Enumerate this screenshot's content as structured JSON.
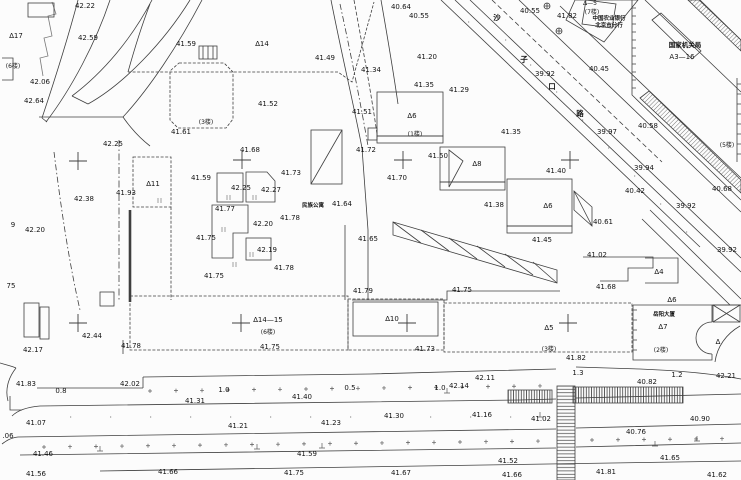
{
  "canvas": {
    "width": 741,
    "height": 480,
    "background": "#fcfcfc",
    "line_color": "#3f3f3f",
    "text_color": "#141414"
  },
  "map_meta": {
    "road_name_vertical": "沙子口路"
  },
  "labels": [
    {
      "t": "42.22",
      "x": 85,
      "y": 8
    },
    {
      "t": "∆17",
      "x": 16,
      "y": 38
    },
    {
      "t": "42.59",
      "x": 88,
      "y": 40
    },
    {
      "t": "41.59",
      "x": 186,
      "y": 46
    },
    {
      "t": "∆14",
      "x": 262,
      "y": 46
    },
    {
      "t": "41.49",
      "x": 325,
      "y": 60
    },
    {
      "t": "40.64",
      "x": 401,
      "y": 9
    },
    {
      "t": "40.55",
      "x": 419,
      "y": 18
    },
    {
      "t": "(6楼)",
      "x": 13,
      "y": 68,
      "c": "s"
    },
    {
      "t": "42.06",
      "x": 40,
      "y": 84
    },
    {
      "t": "41.34",
      "x": 371,
      "y": 72
    },
    {
      "t": "42.64",
      "x": 34,
      "y": 103
    },
    {
      "t": "41.52",
      "x": 268,
      "y": 106
    },
    {
      "t": "41.20",
      "x": 427,
      "y": 59
    },
    {
      "t": "41.35",
      "x": 424,
      "y": 87
    },
    {
      "t": "41.29",
      "x": 459,
      "y": 92
    },
    {
      "t": "41.51",
      "x": 362,
      "y": 114
    },
    {
      "t": "(3楼)",
      "x": 206,
      "y": 124,
      "c": "s"
    },
    {
      "t": "41.61",
      "x": 181,
      "y": 134
    },
    {
      "t": "42.25",
      "x": 113,
      "y": 146
    },
    {
      "t": "40.55",
      "x": 530,
      "y": 13
    },
    {
      "t": "41.82",
      "x": 567,
      "y": 18
    },
    {
      "t": "∆—5",
      "x": 590,
      "y": 5,
      "c": "s"
    },
    {
      "t": "(7楼)",
      "x": 592,
      "y": 14,
      "c": "s"
    },
    {
      "t": "中国农业银行",
      "x": 609,
      "y": 20,
      "c": "cns"
    },
    {
      "t": "北京市分行",
      "x": 609,
      "y": 27,
      "c": "cns"
    },
    {
      "t": "国家机关局",
      "x": 685,
      "y": 47,
      "c": "cnb"
    },
    {
      "t": "A3—16",
      "x": 682,
      "y": 59
    },
    {
      "t": "沙",
      "x": 497,
      "y": 20,
      "c": "cn"
    },
    {
      "t": "子",
      "x": 524,
      "y": 62,
      "c": "cn"
    },
    {
      "t": "口",
      "x": 552,
      "y": 89,
      "c": "cn"
    },
    {
      "t": "路",
      "x": 580,
      "y": 116,
      "c": "cn"
    },
    {
      "t": "39.92",
      "x": 545,
      "y": 76
    },
    {
      "t": "40.45",
      "x": 599,
      "y": 71
    },
    {
      "t": "39.97",
      "x": 607,
      "y": 134
    },
    {
      "t": "40.58",
      "x": 648,
      "y": 128
    },
    {
      "t": "41.35",
      "x": 511,
      "y": 134
    },
    {
      "t": "(5楼)",
      "x": 727,
      "y": 147,
      "c": "s"
    },
    {
      "t": "39.94",
      "x": 644,
      "y": 170
    },
    {
      "t": "40.42",
      "x": 635,
      "y": 193
    },
    {
      "t": "39.92",
      "x": 686,
      "y": 208
    },
    {
      "t": "40.68",
      "x": 722,
      "y": 191
    },
    {
      "t": "39.92",
      "x": 727,
      "y": 252
    },
    {
      "t": "40.61",
      "x": 603,
      "y": 224
    },
    {
      "t": "41.02",
      "x": 597,
      "y": 257
    },
    {
      "t": "41.68",
      "x": 606,
      "y": 289
    },
    {
      "t": "∆4",
      "x": 659,
      "y": 274
    },
    {
      "t": "41.68",
      "x": 250,
      "y": 152
    },
    {
      "t": "41.72",
      "x": 366,
      "y": 152
    },
    {
      "t": "41.50",
      "x": 438,
      "y": 158
    },
    {
      "t": "41.40",
      "x": 556,
      "y": 173
    },
    {
      "t": "∆8",
      "x": 477,
      "y": 166
    },
    {
      "t": "41.73",
      "x": 291,
      "y": 175
    },
    {
      "t": "41.59",
      "x": 201,
      "y": 180
    },
    {
      "t": "41.70",
      "x": 397,
      "y": 180
    },
    {
      "t": "∆11",
      "x": 153,
      "y": 186
    },
    {
      "t": "42.25",
      "x": 241,
      "y": 190
    },
    {
      "t": "42.27",
      "x": 271,
      "y": 192
    },
    {
      "t": "41.93",
      "x": 126,
      "y": 195
    },
    {
      "t": "42.38",
      "x": 84,
      "y": 201
    },
    {
      "t": "41.38",
      "x": 494,
      "y": 207
    },
    {
      "t": "∆6",
      "x": 548,
      "y": 208
    },
    {
      "t": "41.77",
      "x": 225,
      "y": 211
    },
    {
      "t": "民族公寓",
      "x": 313,
      "y": 207,
      "c": "cns"
    },
    {
      "t": "41.64",
      "x": 342,
      "y": 206
    },
    {
      "t": "∆6",
      "x": 412,
      "y": 118
    },
    {
      "t": "(1楼)",
      "x": 415,
      "y": 136,
      "c": "s"
    },
    {
      "t": "42.20",
      "x": 263,
      "y": 226
    },
    {
      "t": "41.78",
      "x": 290,
      "y": 220
    },
    {
      "t": "42.20",
      "x": 35,
      "y": 232
    },
    {
      "t": "9",
      "x": 13,
      "y": 227
    },
    {
      "t": "41.75",
      "x": 206,
      "y": 240
    },
    {
      "t": "41.65",
      "x": 368,
      "y": 241
    },
    {
      "t": "41.45",
      "x": 542,
      "y": 242
    },
    {
      "t": "42.19",
      "x": 267,
      "y": 252
    },
    {
      "t": "41.78",
      "x": 284,
      "y": 270
    },
    {
      "t": "41.75",
      "x": 214,
      "y": 278
    },
    {
      "t": "75",
      "x": 11,
      "y": 288
    },
    {
      "t": "41.75",
      "x": 462,
      "y": 292
    },
    {
      "t": "41.79",
      "x": 363,
      "y": 293
    },
    {
      "t": "∆14—15",
      "x": 268,
      "y": 322
    },
    {
      "t": "(6楼)",
      "x": 268,
      "y": 334,
      "c": "s"
    },
    {
      "t": "∆10",
      "x": 392,
      "y": 321
    },
    {
      "t": "∆5",
      "x": 549,
      "y": 330
    },
    {
      "t": "∆6",
      "x": 672,
      "y": 302
    },
    {
      "t": "岳阳大厦",
      "x": 664,
      "y": 316,
      "c": "cns"
    },
    {
      "t": "∆7",
      "x": 663,
      "y": 329
    },
    {
      "t": "∆",
      "x": 718,
      "y": 344
    },
    {
      "t": "(3楼)",
      "x": 549,
      "y": 351,
      "c": "s"
    },
    {
      "t": "(2楼)",
      "x": 661,
      "y": 352,
      "c": "s"
    },
    {
      "t": "42.44",
      "x": 92,
      "y": 338
    },
    {
      "t": "41.78",
      "x": 131,
      "y": 348
    },
    {
      "t": "42.17",
      "x": 33,
      "y": 352
    },
    {
      "t": "41.75",
      "x": 270,
      "y": 349
    },
    {
      "t": "41.73",
      "x": 425,
      "y": 351
    },
    {
      "t": "41.82",
      "x": 576,
      "y": 360
    },
    {
      "t": "41.83",
      "x": 26,
      "y": 386
    },
    {
      "t": "42.02",
      "x": 130,
      "y": 386
    },
    {
      "t": "0.8",
      "x": 61,
      "y": 393
    },
    {
      "t": "1.0",
      "x": 224,
      "y": 392
    },
    {
      "t": "0.5",
      "x": 350,
      "y": 390
    },
    {
      "t": "1.0",
      "x": 440,
      "y": 390
    },
    {
      "t": "42.14",
      "x": 459,
      "y": 388
    },
    {
      "t": "42.11",
      "x": 485,
      "y": 380
    },
    {
      "t": "1.3",
      "x": 578,
      "y": 375
    },
    {
      "t": "1.2",
      "x": 677,
      "y": 377
    },
    {
      "t": "42.21",
      "x": 726,
      "y": 378
    },
    {
      "t": "40.82",
      "x": 647,
      "y": 384
    },
    {
      "t": "41.31",
      "x": 195,
      "y": 403
    },
    {
      "t": "41.40",
      "x": 302,
      "y": 399
    },
    {
      "t": "41.07",
      "x": 36,
      "y": 425
    },
    {
      "t": "41.30",
      "x": 394,
      "y": 418
    },
    {
      "t": "41.16",
      "x": 482,
      "y": 417
    },
    {
      "t": "41.21",
      "x": 238,
      "y": 428
    },
    {
      "t": "41.23",
      "x": 331,
      "y": 425
    },
    {
      "t": "41.02",
      "x": 541,
      "y": 421
    },
    {
      "t": "40.90",
      "x": 700,
      "y": 421
    },
    {
      "t": ".06",
      "x": 8,
      "y": 438
    },
    {
      "t": "40.76",
      "x": 636,
      "y": 434
    },
    {
      "t": "41.46",
      "x": 43,
      "y": 456
    },
    {
      "t": "41.59",
      "x": 307,
      "y": 456
    },
    {
      "t": "41.52",
      "x": 508,
      "y": 463
    },
    {
      "t": "41.65",
      "x": 670,
      "y": 460
    },
    {
      "t": "41.56",
      "x": 36,
      "y": 476
    },
    {
      "t": "41.66",
      "x": 168,
      "y": 474
    },
    {
      "t": "41.75",
      "x": 294,
      "y": 475
    },
    {
      "t": "41.67",
      "x": 401,
      "y": 475
    },
    {
      "t": "41.66",
      "x": 512,
      "y": 477
    },
    {
      "t": "41.81",
      "x": 606,
      "y": 474
    },
    {
      "t": "41.62",
      "x": 717,
      "y": 477
    }
  ],
  "grid_crosses": [
    [
      78,
      161
    ],
    [
      242,
      160
    ],
    [
      403,
      160
    ],
    [
      570,
      160
    ],
    [
      78,
      323
    ],
    [
      241,
      323
    ],
    [
      407,
      323
    ],
    [
      568,
      323
    ]
  ]
}
